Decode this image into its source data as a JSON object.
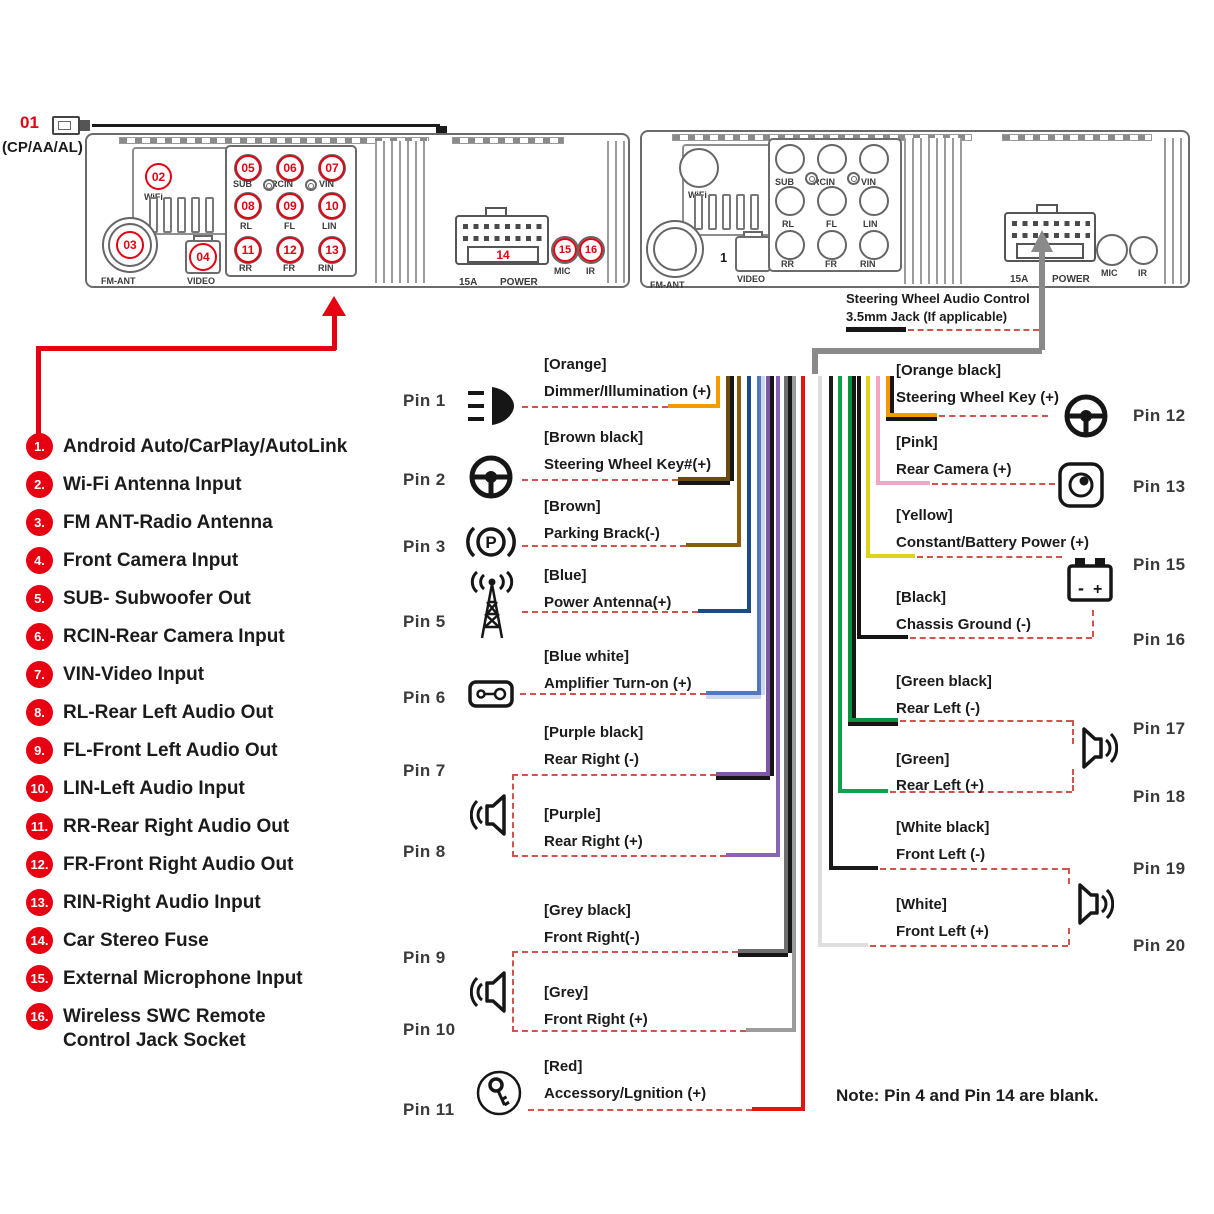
{
  "callout01": {
    "number": "01",
    "caption": "(CP/AA/AL)"
  },
  "swc": {
    "line1": "Steering Wheel Audio Control",
    "line2": "3.5mm Jack (If applicable)",
    "hex": "#8A8A8A"
  },
  "unit1": {
    "badges": {
      "wifi": "02",
      "fm_ant": "03",
      "video": "04",
      "sub": "05",
      "rcin": "06",
      "vin": "07",
      "rl": "08",
      "fl": "09",
      "lin": "10",
      "rr": "11",
      "fr": "12",
      "rin": "13",
      "fuse": "14",
      "mic": "15",
      "ir": "16"
    },
    "labels": {
      "wifi": "WiFi",
      "fm_ant": "FM-ANT",
      "video": "VIDEO",
      "fuse_amp": "15A",
      "power": "POWER",
      "mic": "MIC",
      "ir": "IR"
    },
    "ports": {
      "sub": "SUB",
      "rcin": "RCIN",
      "vin": "VIN",
      "rl": "RL",
      "fl": "FL",
      "lin": "LIN",
      "rr": "RR",
      "fr": "FR",
      "rin": "RIN"
    }
  },
  "unit2": {
    "video_index": "1",
    "labels": {
      "wifi": "WiFi",
      "fm_ant": "FM-ANT",
      "video": "VIDEO",
      "fuse_amp": "15A",
      "power": "POWER",
      "mic": "MIC",
      "ir": "IR"
    },
    "ports": {
      "sub": "SUB",
      "rcin": "RCIN",
      "vin": "VIN",
      "rl": "RL",
      "fl": "FL",
      "lin": "LIN",
      "rr": "RR",
      "fr": "FR",
      "rin": "RIN"
    }
  },
  "legend": {
    "items": [
      {
        "num": "1.",
        "text": "Android Auto/CarPlay/AutoLink"
      },
      {
        "num": "2.",
        "text": "Wi-Fi Antenna Input"
      },
      {
        "num": "3.",
        "text": "FM ANT-Radio Antenna"
      },
      {
        "num": "4.",
        "text": "Front Camera Input"
      },
      {
        "num": "5.",
        "text": "SUB- Subwoofer Out"
      },
      {
        "num": "6.",
        "text": "RCIN-Rear Camera Input"
      },
      {
        "num": "7.",
        "text": "VIN-Video Input"
      },
      {
        "num": "8.",
        "text": "RL-Rear Left Audio Out"
      },
      {
        "num": "9.",
        "text": "FL-Front Left Audio Out"
      },
      {
        "num": "10.",
        "text": "LIN-Left Audio Input"
      },
      {
        "num": "11.",
        "text": "RR-Rear Right Audio Out"
      },
      {
        "num": "12.",
        "text": "FR-Front Right Audio Out"
      },
      {
        "num": "13.",
        "text": "RIN-Right Audio Input"
      },
      {
        "num": "14.",
        "text": "Car Stereo Fuse"
      },
      {
        "num": "15.",
        "text": "External Microphone Input"
      },
      {
        "num": "16.",
        "text": "Wireless SWC Remote",
        "text2": "Control Jack Socket"
      }
    ]
  },
  "pins_left": [
    {
      "label": "Pin 1",
      "color": "[Orange]",
      "func": "Dimmer/Illumination (+)",
      "hex": "#F59A00",
      "icon": "headlight-icon"
    },
    {
      "label": "Pin 2",
      "color": "[Brown black]",
      "func": "Steering Wheel Key#(+)",
      "hex": "#6B4A0E",
      "icon": "steering-wheel-icon"
    },
    {
      "label": "Pin 3",
      "color": "[Brown]",
      "func": "Parking Brack(-)",
      "hex": "#8A5C10",
      "icon": "parking-brake-icon"
    },
    {
      "label": "Pin 5",
      "color": "[Blue]",
      "func": "Power Antenna(+)",
      "hex": "#1A4C8C",
      "icon": "antenna-icon"
    },
    {
      "label": "Pin 6",
      "color": "[Blue white]",
      "func": "Amplifier Turn-on (+)",
      "hex": "#5377BE",
      "icon": "amplifier-icon"
    },
    {
      "label": "Pin 7",
      "color": "[Purple black]",
      "func": "Rear Right (-)",
      "hex": "#7E57A5",
      "icon": "speaker-icon"
    },
    {
      "label": "Pin 8",
      "color": "[Purple]",
      "func": "Rear Right (+)",
      "hex": "#8A63B5",
      "icon": "speaker-icon"
    },
    {
      "label": "Pin 9",
      "color": "[Grey black]",
      "func": "Front Right(-)",
      "hex": "#6E6E6E",
      "icon": "speaker-icon"
    },
    {
      "label": "Pin 10",
      "color": "[Grey]",
      "func": "Front Right (+)",
      "hex": "#9C9C9C",
      "icon": "speaker-icon"
    },
    {
      "label": "Pin 11",
      "color": "[Red]",
      "func": "Accessory/Lgnition (+)",
      "hex": "#E8120C",
      "icon": "ignition-key-icon"
    }
  ],
  "pins_right": [
    {
      "label": "Pin 12",
      "color": "[Orange black]",
      "func": "Steering Wheel Key (+)",
      "hex": "#F59A00",
      "icon": "steering-wheel-icon"
    },
    {
      "label": "Pin 13",
      "color": "[Pink]",
      "func": "Rear Camera (+)",
      "hex": "#F2A6C6",
      "icon": "camera-icon"
    },
    {
      "label": "Pin 15",
      "color": "[Yellow]",
      "func": "Constant/Battery Power (+)",
      "hex": "#DDD31C",
      "icon": "battery-icon"
    },
    {
      "label": "Pin 16",
      "color": "[Black]",
      "func": "Chassis Ground (-)",
      "hex": "#141414",
      "icon": "battery-icon"
    },
    {
      "label": "Pin 17",
      "color": "[Green black]",
      "func": "Rear Left (-)",
      "hex": "#0A9142",
      "icon": "speaker-icon"
    },
    {
      "label": "Pin 18",
      "color": "[Green]",
      "func": "Rear Left (+)",
      "hex": "#0FA24C",
      "icon": "speaker-icon"
    },
    {
      "label": "Pin 19",
      "color": "[White black]",
      "func": "Front Left (-)",
      "hex": "#1A1A1A",
      "icon": "speaker-icon"
    },
    {
      "label": "Pin 20",
      "color": "[White]",
      "func": "Front Left (+)",
      "hex": "#DEDEDE",
      "icon": "speaker-icon"
    }
  ],
  "note": "Note: Pin 4 and Pin 14 are blank.",
  "colors": {
    "accent_red": "#E60012",
    "dash_red": "#D0544C",
    "wire_stripe_black": "#161616"
  }
}
